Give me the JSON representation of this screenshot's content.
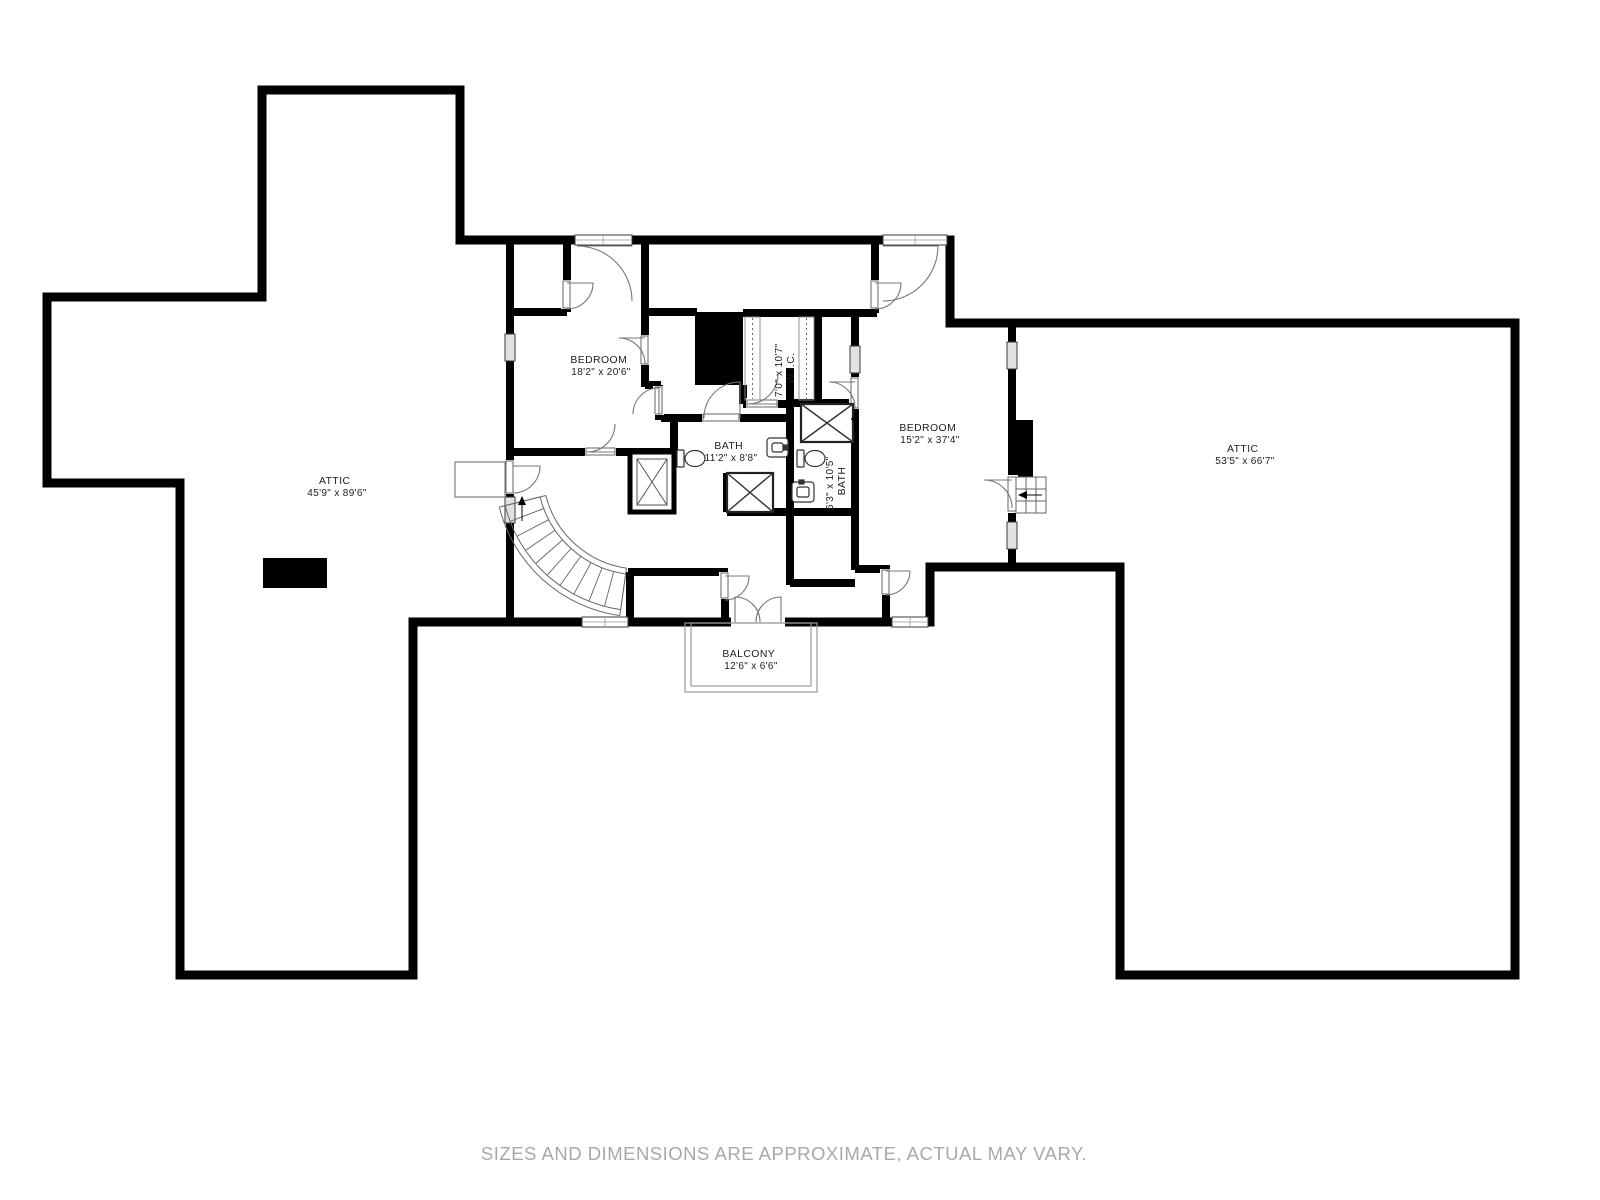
{
  "disclaimer": "SIZES AND DIMENSIONS ARE APPROXIMATE, ACTUAL MAY VARY.",
  "rooms": {
    "attic_left": {
      "name": "ATTIC",
      "dims": "45'9\" x 89'6\""
    },
    "bedroom_left": {
      "name": "BEDROOM",
      "dims": "18'2\" x 20'6\""
    },
    "wic": {
      "name": "W.I.C.",
      "dims": "7'0\" x 10'7\""
    },
    "bath_main": {
      "name": "BATH",
      "dims": "11'2\" x 8'8\""
    },
    "bath_small": {
      "name": "BATH",
      "dims": "6'3\" x 10'5\""
    },
    "bedroom_right": {
      "name": "BEDROOM",
      "dims": "15'2\" x 37'4\""
    },
    "attic_right": {
      "name": "ATTIC",
      "dims": "53'5\" x 66'7\""
    },
    "balcony": {
      "name": "BALCONY",
      "dims": "12'6\" x 6'6\""
    }
  },
  "colors": {
    "wall": "#000000",
    "background": "#ffffff",
    "thin_line": "#666666",
    "label_text": "#1c1c1c",
    "disclaimer_text": "#a8a8a8"
  }
}
